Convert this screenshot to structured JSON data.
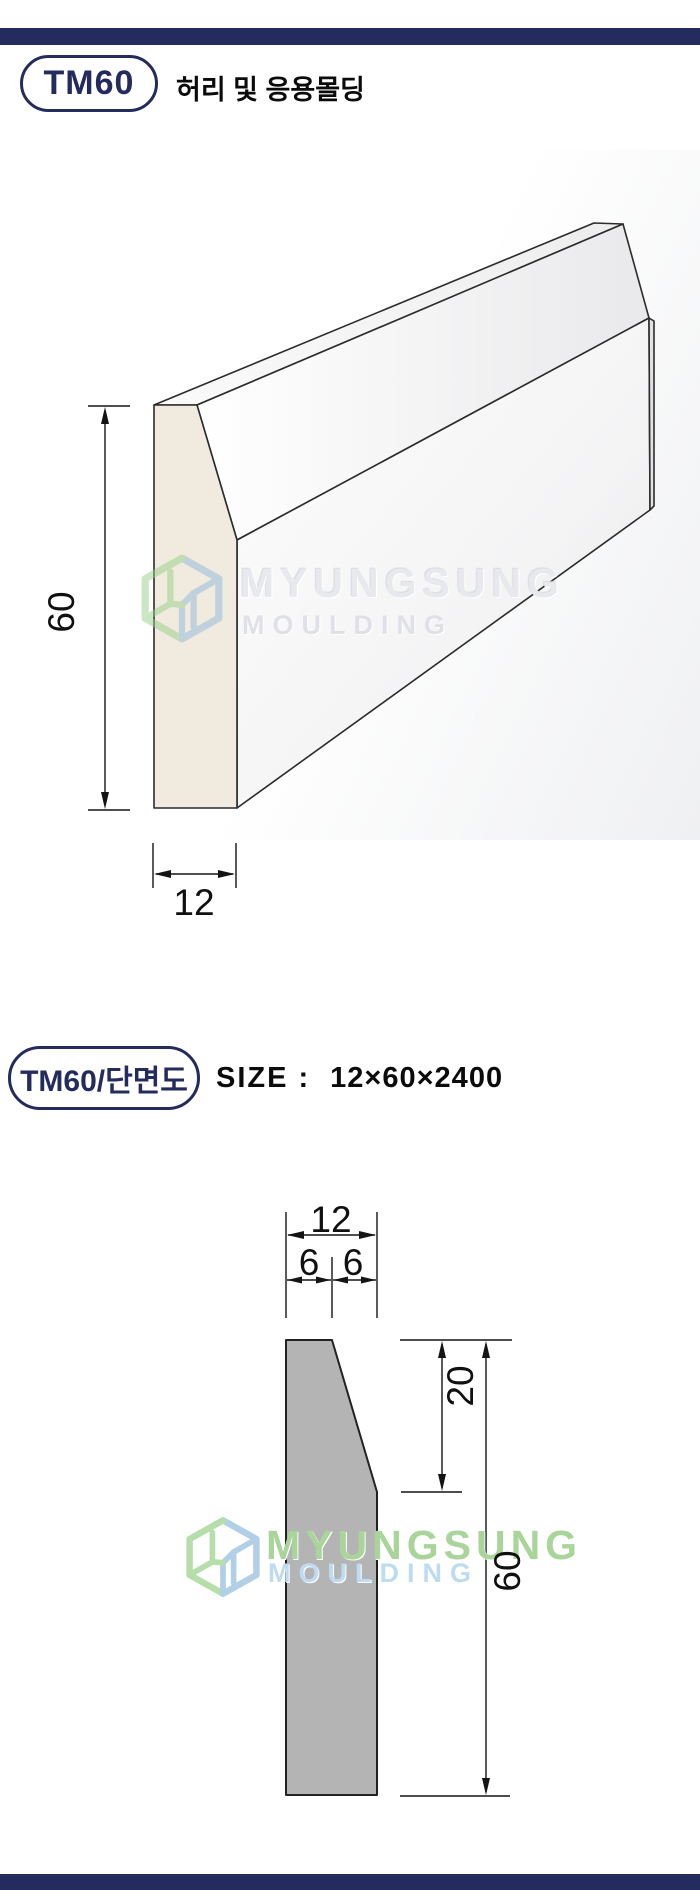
{
  "page": {
    "product": {
      "badge_label": "TM60",
      "category_label": "허리 및 응용몰딩"
    },
    "section": {
      "badge_label": "TM60/단면도",
      "size_label": "SIZE :",
      "size_value": "12×60×2400"
    },
    "watermark": {
      "name": "MYUNGSUNG",
      "subname": "MOULDING"
    },
    "drawing_3d": {
      "height_label": "60",
      "width_label": "12"
    },
    "drawing_section": {
      "width_label": "12",
      "half_left_label": "6",
      "half_right_label": "6",
      "chamfer_label": "20",
      "height_label": "60"
    },
    "colors": {
      "navy": "#242b5e",
      "profile_gray": "#b4b4b4",
      "wood_face": "#f1ebdf",
      "watermark_green": "#a9d59b",
      "watermark_blue": "#bddcf2",
      "line": "#141414"
    }
  }
}
